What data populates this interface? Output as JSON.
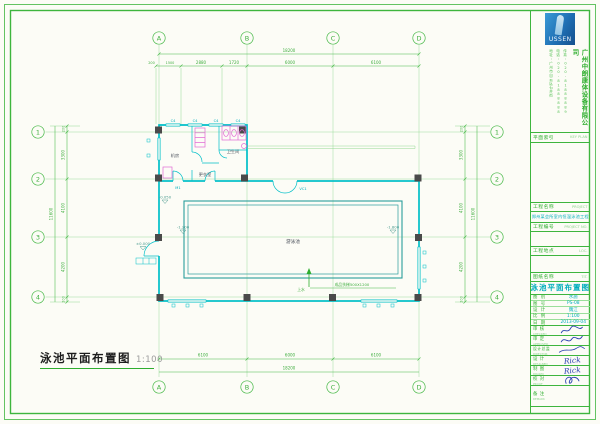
{
  "drawing": {
    "title": "泳池平面布置图",
    "scale": "1:100",
    "grid_cols": [
      "A",
      "B",
      "C",
      "D"
    ],
    "grid_rows": [
      "1",
      "2",
      "3",
      "4"
    ],
    "dims": {
      "top_overall": "18200",
      "top_chain": [
        "200",
        "1500",
        "2880",
        "1720",
        "6000",
        "6100"
      ],
      "bottom_chain": [
        "6100",
        "6000",
        "6100"
      ],
      "bottom_overall": "18200",
      "side_chain": [
        "3300",
        "4100",
        "4200"
      ],
      "side_overall": "11600",
      "side_offset": "200"
    },
    "labels": {
      "pool": "游泳池",
      "room_plant": "机房",
      "room_changing": "更衣室",
      "room_wc": "卫生间",
      "window_tag": "C4",
      "door_m1": "M1",
      "door_vc1": "VC1",
      "ladder_note": "成品扶梯500X1200",
      "inlet": "上水",
      "lv_entry": "±0.000",
      "lv_hall": "-0.050",
      "lv_shallow": "-1.200",
      "lv_deep": "-1.800"
    }
  },
  "titleblock": {
    "logo_text": "USSEN",
    "company_name": "广州中朗康体设备有限公司",
    "contact_col1": "地址:广州市白云区石井街",
    "contact_col2": "电话:020-81888888",
    "contact_col3": "传真:020-81888889",
    "key_plan": {
      "label": "平面索引",
      "en": "KEY PLAN"
    },
    "project": {
      "label": "工程名称",
      "en": "PROJECT",
      "value": "郑州某会所室内恒温泳池工程"
    },
    "project_no": {
      "label": "工程编号",
      "en": "PROJECT NO."
    },
    "location": {
      "label": "工程地点",
      "en": "LOC."
    },
    "sheet_title": {
      "label": "图纸名称",
      "en": "TIT.",
      "value": "泳池平面布置图"
    },
    "info_rows": [
      {
        "label": "图 别",
        "value": "水施"
      },
      {
        "label": "图 号",
        "value": "PS-08"
      },
      {
        "label": "设 计",
        "value": "魏江"
      },
      {
        "label": "比 例",
        "value": "1:100"
      },
      {
        "label": "日 期",
        "value": "2013-09-04"
      }
    ],
    "sign_rows": [
      {
        "label": "审 核",
        "en": "CHECKED"
      },
      {
        "label": "审 定",
        "en": "APPROVED"
      },
      {
        "label": "设计总监",
        "en": "DIRECTOR"
      },
      {
        "label": "设 计",
        "en": "DESIGNED",
        "sig": "Rick"
      },
      {
        "label": "制 图",
        "en": "DRAWN",
        "sig": "Rick"
      },
      {
        "label": "校 对",
        "en": "PROOF"
      },
      {
        "label": "备 注",
        "en": "REMARK"
      }
    ]
  }
}
